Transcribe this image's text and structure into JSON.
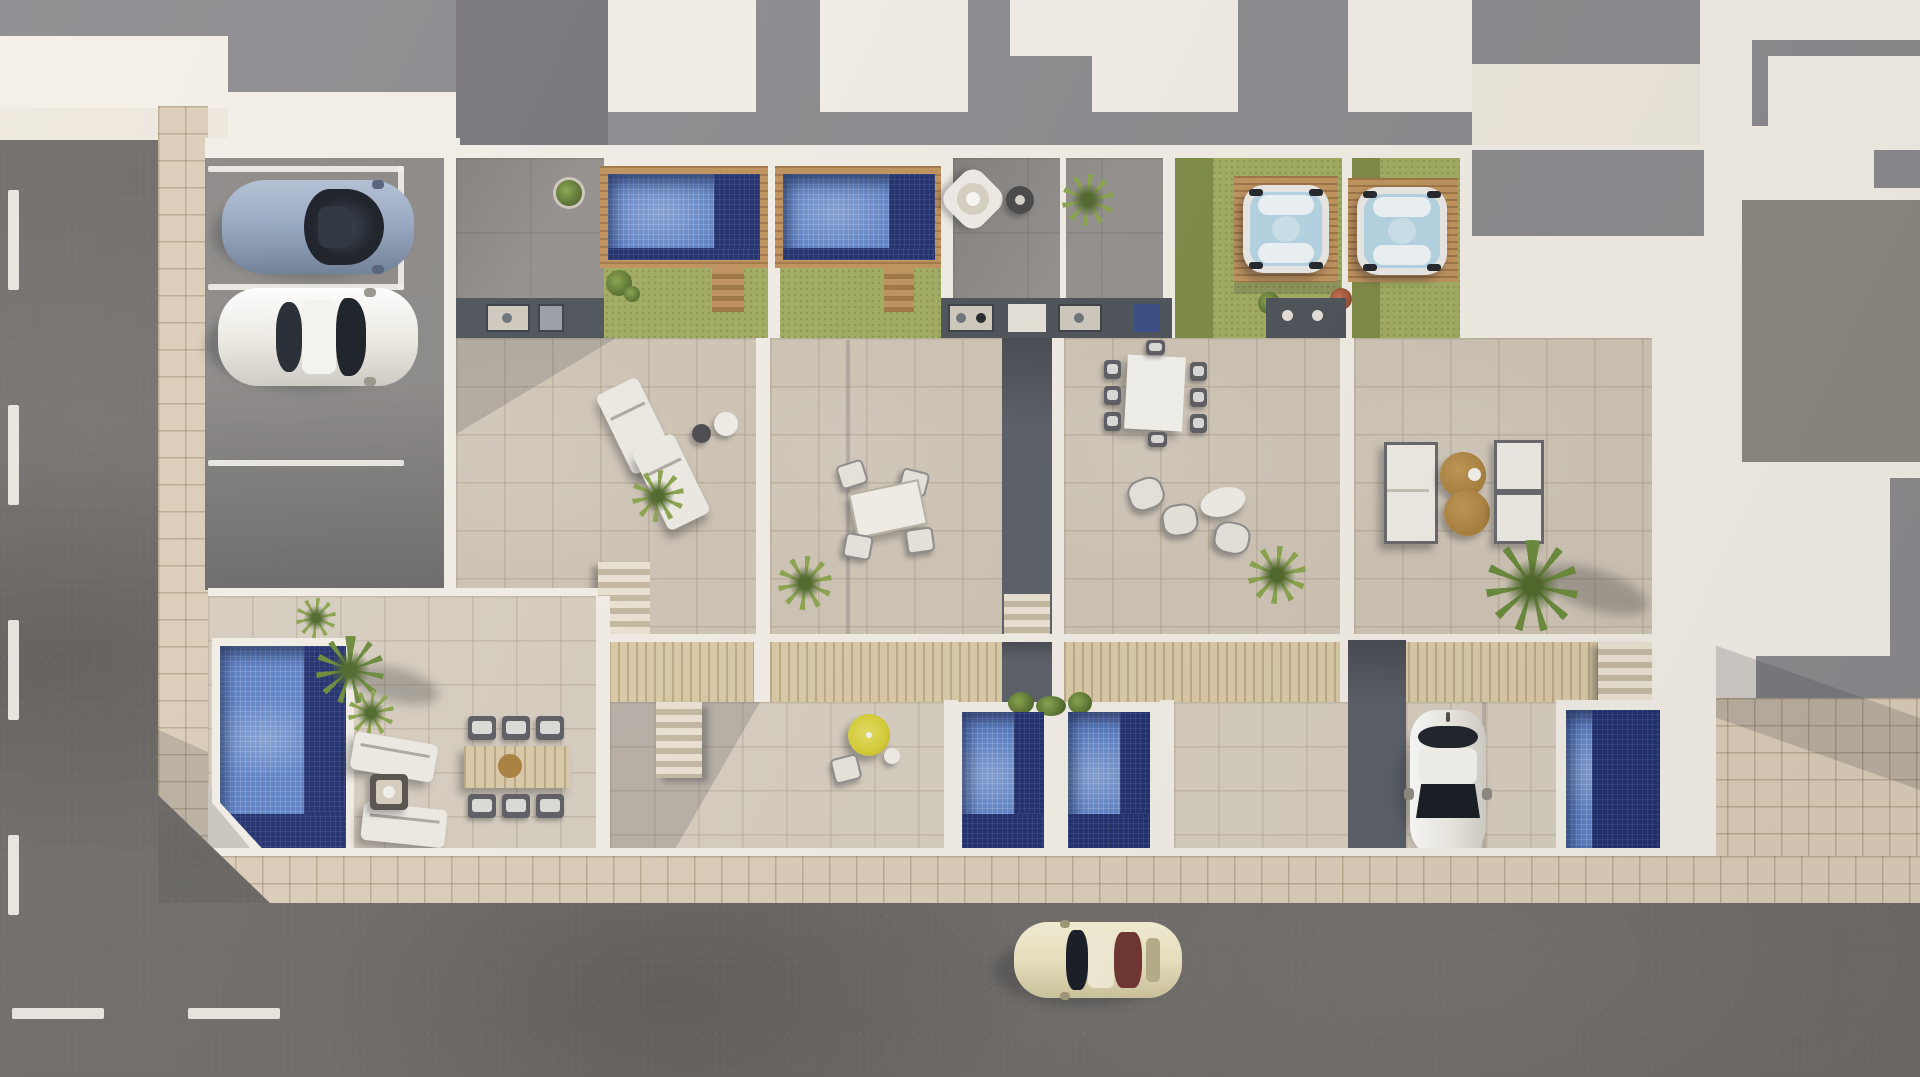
{
  "scene": {
    "title": "Aerial 3D architectural rendering of a terraced residential complex",
    "view": "top-down bird's-eye render, afternoon sun casting shadows to the lower-left",
    "site": {
      "roads": [
        {
          "name": "left-road",
          "orientation": "vertical",
          "surface": "dark asphalt",
          "marking": "white dashed lane line"
        },
        {
          "name": "bottom-road",
          "orientation": "horizontal",
          "surface": "dark asphalt",
          "marking": "white dashes near left corner"
        }
      ],
      "sidewalks": [
        {
          "name": "left-sidewalk",
          "material": "beige paving tiles"
        },
        {
          "name": "bottom-sidewalk",
          "material": "beige paving tiles",
          "note": "chamfered corner where the two streets meet"
        }
      ],
      "parking": {
        "stalls": 3,
        "marking": "white stall lines",
        "occupied_by": [
          "blue coupe",
          "white hatchback"
        ]
      }
    },
    "residences": {
      "upper_roof_gardens": [
        {
          "name": "unit-a",
          "features": [
            "shaded gray terrace",
            "round potted plant",
            "mosaic pool in timber deck",
            "lawn with timber steps",
            "outdoor kitchen counters"
          ]
        },
        {
          "name": "unit-b",
          "features": [
            "mosaic pool in timber deck",
            "lawn with timber steps",
            "gray terrace",
            "white hanging chair",
            "fire bowl",
            "fern"
          ]
        },
        {
          "name": "unit-c",
          "features": [
            "lawn",
            "square hot tub on timber deck",
            "outdoor kitchen"
          ]
        },
        {
          "name": "unit-d",
          "features": [
            "lawn",
            "square hot tub on timber deck",
            "flowering shrubs"
          ]
        }
      ],
      "main_terraces": [
        {
          "name": "terrace-1",
          "furniture": [
            "two angled sun loungers",
            "round side tables",
            "fern",
            "staircase down"
          ]
        },
        {
          "name": "terrace-2",
          "furniture": [
            "tilted dining table with four chairs",
            "fern"
          ]
        },
        {
          "name": "terrace-3",
          "furniture": [
            "eight-seat white dining table with dark chairs",
            "lounge chairs with oval table",
            "fern"
          ]
        },
        {
          "name": "terrace-4",
          "furniture": [
            "outdoor sofa",
            "two round rattan poufs",
            "two armchairs",
            "palm tree",
            "staircase down"
          ]
        }
      ],
      "lower_gardens": [
        {
          "name": "corner-garden",
          "features": [
            "angled mosaic pool",
            "palms and ferns",
            "two loungers",
            "fire table",
            "timber dining table with six chairs"
          ]
        },
        {
          "name": "patio-garden",
          "features": [
            "staircase",
            "yellow parasol",
            "bistro chair and table"
          ]
        },
        {
          "name": "twin-plunge-pools",
          "features": [
            "two mosaic plunge pools",
            "trailing planter"
          ]
        },
        {
          "name": "driveway-garden",
          "features": [
            "dark side passage",
            "parked white car",
            "plunge pool"
          ]
        }
      ]
    },
    "vehicles": [
      {
        "name": "blue-coupe",
        "color_key": "carblue",
        "location": "parking stall 1",
        "heading": "east"
      },
      {
        "name": "white-hatchback",
        "color_key": "carwhite",
        "location": "parking stall 2",
        "heading": "east"
      },
      {
        "name": "white-car-driveway",
        "color_key": "carwhite",
        "location": "driveway",
        "heading": "south"
      },
      {
        "name": "cream-classic-car",
        "color_key": "carcream",
        "location": "bottom road",
        "heading": "west"
      }
    ],
    "water_features": {
      "roof_pools": 2,
      "hot_tubs": 2,
      "ground_pools": 4
    },
    "surroundings": "white flat neighbouring rooftops with deep gray cast shadows above and to the right"
  },
  "colors": {
    "plaster": "#efe9df",
    "wall": "#f4f0e8",
    "asphalt": "#6f6b68",
    "roadline": "#f2efe8",
    "sidetile": "#dccfba",
    "tile": "#d0c6b7",
    "tile2": "#d8cfc1",
    "parking": "#8c8987",
    "slate": "#4e535a",
    "walkway": "#5b5f67",
    "terrgray": "#95918e",
    "topgray": "#8c8c90",
    "topgray2": "#78757c",
    "lawn": "#a3ad61",
    "lawndark": "#7f8b46",
    "wood": "#c1945e",
    "wooddark": "#9f7843",
    "deck": "#dbcba8",
    "pool": "#5c81c7",
    "pooldeep": "#20306e",
    "tubwater": "#b7d6e5",
    "tubwhite": "#edebe7",
    "carblue": "#97a9c2",
    "carwhite": "#efece5",
    "carcream": "#eee6c2",
    "glass": "#181c24",
    "maroon": "#703431",
    "pouf": "#aa813f",
    "leaf": "#6d8c3d",
    "leafdark": "#50682b",
    "leaflight": "#8ca54e",
    "yellow": "#d8cf35",
    "counter": "#d2cbc0",
    "bluepanel": "#3a4e86"
  }
}
